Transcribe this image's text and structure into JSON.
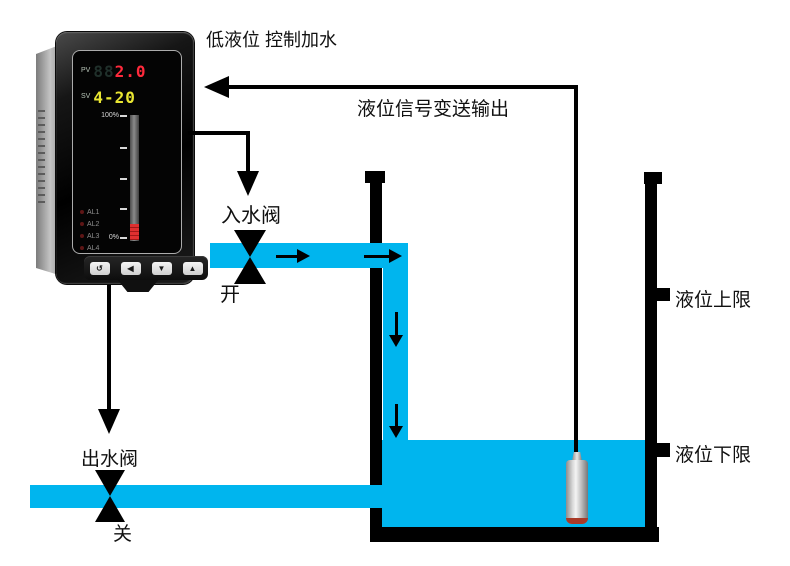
{
  "meter": {
    "pv_label": "PV",
    "pv_ghost": "88",
    "pv_value": "2.0",
    "sv_label": "SV",
    "sv_value": "4-20",
    "bargraph": {
      "top_label": "100%",
      "bottom_label": "0%",
      "fill_percent": 13
    },
    "alarms": [
      "AL1",
      "AL2",
      "AL3",
      "AL4"
    ],
    "buttons": [
      "↺",
      "◀",
      "▼",
      "▲"
    ]
  },
  "annotations": {
    "top_note": "低液位 控制加水",
    "signal_output": "液位信号变送输出",
    "inlet_valve": "入水阀",
    "inlet_state": "开",
    "outlet_valve": "出水阀",
    "outlet_state": "关",
    "upper_limit": "液位上限",
    "lower_limit": "液位下限"
  },
  "colors": {
    "water": "#00b5ee",
    "line": "#000000",
    "pv_digit_red": "#ff2a3c",
    "sv_digit_yellow": "#e9e632",
    "bar_fill_red": "#d02020"
  }
}
